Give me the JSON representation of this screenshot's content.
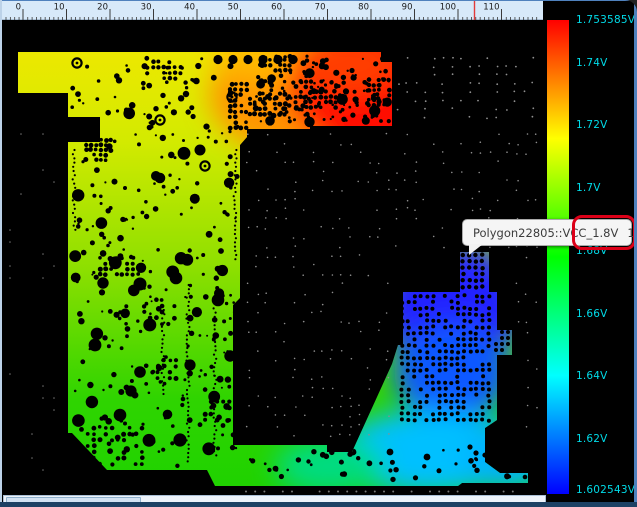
{
  "window": {
    "frame_color": "#4f81bd",
    "bottom_strip_color": "#1d4164",
    "canvas_background": "#000000"
  },
  "ruler": {
    "labels": [
      "0",
      "10",
      "20",
      "30",
      "40",
      "50",
      "60",
      "70",
      "80",
      "90",
      "100",
      "110"
    ],
    "background": "#d7e9f9",
    "tick_color": "#3a3a3a",
    "cursor_marker_color": "#e23b3b"
  },
  "color_scale": {
    "unit": "V",
    "max_value": 1.753585,
    "min_value": 1.602543,
    "labels": [
      "1.753585V",
      "1.74V",
      "1.72V",
      "1.7V",
      "1.68V",
      "1.66V",
      "1.64V",
      "1.62V",
      "1.602543V"
    ],
    "values": [
      1.753585,
      1.74,
      1.72,
      1.7,
      1.68,
      1.66,
      1.64,
      1.62,
      1.602543
    ],
    "label_color": "#00dbe8",
    "top_color": "#ff0000",
    "bottom_color": "#0000ff"
  },
  "tooltip": {
    "polygon_net": "Polygon22805::VCC_1.8V",
    "voltage": "1.60439V",
    "highlight_color": "#dc0018"
  },
  "chart_data": {
    "type": "heatmap",
    "title": "",
    "units": "V",
    "colorbar": {
      "min": 1.602543,
      "max": 1.753585,
      "ticks": [
        1.753585,
        1.74,
        1.72,
        1.7,
        1.68,
        1.66,
        1.64,
        1.62,
        1.602543
      ],
      "orientation": "vertical",
      "position": "right",
      "colormap": "red-green-blue (hue 0 to 240)"
    },
    "probed_point": {
      "net": "Polygon22805::VCC_1.8V",
      "value_volts": 1.60439
    },
    "regions": [
      {
        "area": "top-right plane block",
        "approx_volts": 1.75
      },
      {
        "area": "top-left plane",
        "approx_volts": 1.72
      },
      {
        "area": "mid-left plane",
        "approx_volts": 1.7
      },
      {
        "area": "bottom-left plane",
        "approx_volts": 1.67
      },
      {
        "area": "bottom-right cyan plane",
        "approx_volts": 1.635
      },
      {
        "area": "bottom-right blue cluster (probe)",
        "approx_volts": 1.604
      }
    ]
  }
}
